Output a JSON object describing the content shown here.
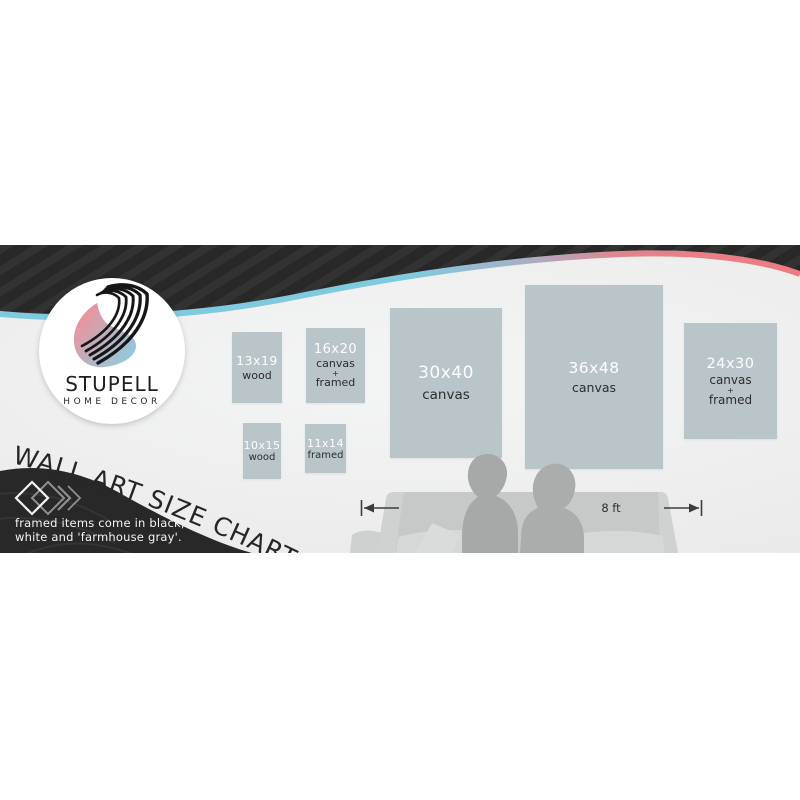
{
  "brand": {
    "name": "STUPELL",
    "subtitle": "HOME DECOR",
    "logo_icon": "s-swoosh-icon"
  },
  "title": "WALL ART SIZE CHART",
  "note": {
    "line1": "framed items come in black,",
    "line2": "white and 'farmhouse gray'."
  },
  "scale": {
    "label": "8 ft"
  },
  "art_items": [
    {
      "size": "13x19",
      "l1": "wood"
    },
    {
      "size": "16x20",
      "l1": "canvas",
      "l2": "+",
      "l3": "framed"
    },
    {
      "size": "10x15",
      "l1": "wood"
    },
    {
      "size": "11x14",
      "l1": "framed"
    },
    {
      "size": "30x40",
      "l1": "canvas"
    },
    {
      "size": "36x48",
      "l1": "canvas"
    },
    {
      "size": "24x30",
      "l1": "canvas",
      "l2": "+",
      "l3": "framed"
    }
  ],
  "colors": {
    "dark_band": "#282828",
    "accent_blue": "#7fcadf",
    "accent_red": "#ee7a80",
    "frame_fill": "#b9c5c8",
    "wall": "#ecedec",
    "couch": "#c7c9c8",
    "silhouette": "#a7a9a8",
    "logo_pink": "#f09098",
    "logo_blue": "#84d2ea"
  }
}
